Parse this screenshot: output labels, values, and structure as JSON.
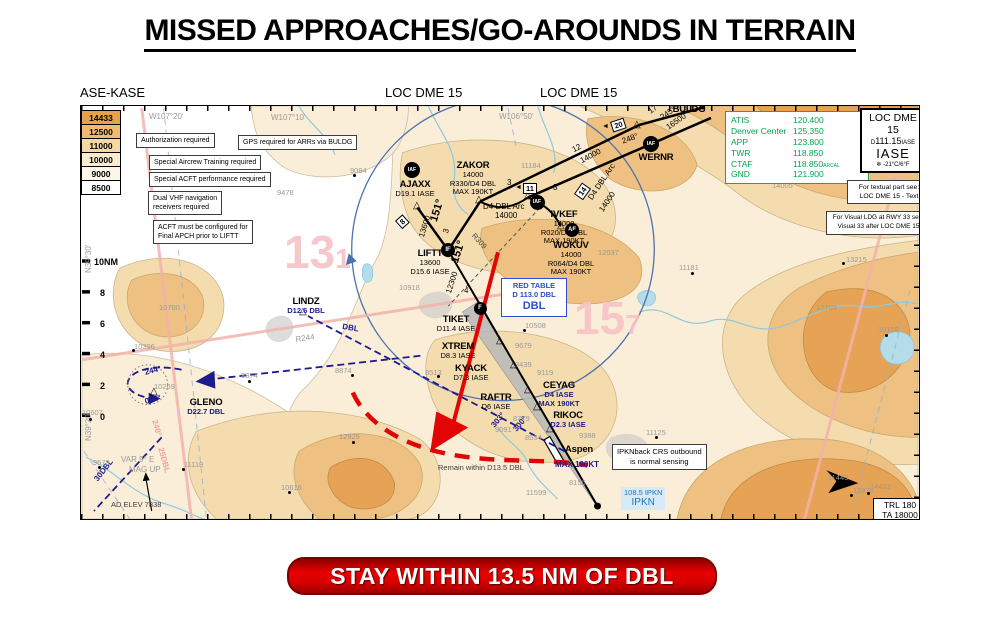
{
  "title": "MISSED APPROACHES/GO-AROUNDS IN TERRAIN",
  "header": {
    "chart_code": "ASE-KASE",
    "procedure_left": "LOC DME 15",
    "procedure_right": "LOC DME 15"
  },
  "banner": "STAY WITHIN 13.5 NM OF DBL",
  "elevation_legend": [
    {
      "value": "14433",
      "color": "#e7a14c"
    },
    {
      "value": "12500",
      "color": "#efba74"
    },
    {
      "value": "11000",
      "color": "#f6d8a5"
    },
    {
      "value": "10000",
      "color": "#fbeccf"
    },
    {
      "value": "9000",
      "color": "#fdf6e9"
    },
    {
      "value": "8500",
      "color": "#ffffff"
    }
  ],
  "notes": {
    "auth": "Authorization required",
    "gps": "GPS required for ARRs via BULDG",
    "training": "Special Aircrew Training required",
    "performance": "Special ACFT performance required",
    "dual_vhf": "Dual VHF navigation\nreceivers required",
    "config": "ACFT must be configured for\nFinal APCH prior to LIFTT",
    "ipkn": "IPKNback CRS outbound\nis normal sensing"
  },
  "comms": {
    "rows": [
      {
        "label": "ATIS",
        "value": "120.400"
      },
      {
        "label": "Denver Center",
        "value": "125.350"
      },
      {
        "label": "APP",
        "value": "123.800"
      },
      {
        "label": "TWR",
        "value": "118.850"
      },
      {
        "label": "CTAF",
        "value": "118.850",
        "suffix": "ARCAL"
      },
      {
        "label": "GND",
        "value": "121.900"
      }
    ]
  },
  "procedure_box": {
    "l1": "LOC DME",
    "l2": "15",
    "freq_prefix": "D",
    "freq": "111.15",
    "ident_small": "IASE",
    "ident": "IASE",
    "snow": "❄",
    "temp": "-21°C/6°F"
  },
  "ref_boxes": {
    "textual": "For textual part see:\nLOC DME 15 - Text",
    "visual": "For Visual LDG at RWY 33 see:\nVisual 33 after LOC DME 15"
  },
  "trl_box": {
    "l1": "TRL 180",
    "l2": "TA 18000"
  },
  "red_table": {
    "l1": "RED TABLE",
    "l2": "D 113.0 DBL",
    "l3": "DBL"
  },
  "ipkn_freq": {
    "l1": "108.5 IPKN",
    "l2": "IPKN"
  },
  "map": {
    "mora": [
      {
        "big": "13",
        "small": "1",
        "x": 283,
        "y": 228
      },
      {
        "big": "15",
        "small": "7",
        "x": 573,
        "y": 294
      }
    ],
    "waypoints": [
      {
        "n": "BULDG",
        "x": 688,
        "y": 104,
        "lines": []
      },
      {
        "n": "WERNR",
        "x": 655,
        "y": 152,
        "lines": []
      },
      {
        "n": "ZAKOR",
        "x": 472,
        "y": 160,
        "lines": [
          "14000",
          "R330/D4 DBL",
          "MAX 190KT"
        ]
      },
      {
        "n": "AJAXX",
        "x": 414,
        "y": 179,
        "lines": [
          "D19.1 IASE"
        ]
      },
      {
        "n": "IVKEF",
        "x": 563,
        "y": 209,
        "lines": [
          "14000",
          "R020/D4 DBL",
          "MAX 190KT"
        ]
      },
      {
        "n": "WOKUV",
        "x": 570,
        "y": 240,
        "lines": [
          "14000",
          "R064/D4 DBL",
          "MAX 190KT"
        ]
      },
      {
        "n": "LIFTT",
        "x": 429,
        "y": 248,
        "lines": [
          "13600",
          "D15.6 IASE"
        ]
      },
      {
        "n": "TIKET",
        "x": 455,
        "y": 314,
        "lines": [
          "D11.4 IASE"
        ]
      },
      {
        "n": "XTREM",
        "x": 457,
        "y": 341,
        "lines": [
          "D8.3 IASE"
        ]
      },
      {
        "n": "KYACK",
        "x": 470,
        "y": 363,
        "lines": [
          "D7.3 IASE"
        ]
      },
      {
        "n": "RAFTR",
        "x": 495,
        "y": 392,
        "lines": [
          "D6 IASE"
        ]
      },
      {
        "n": "CEYAG",
        "x": 558,
        "y": 380,
        "lines": [
          "D4 IASE",
          "MAX 190KT"
        ],
        "lc": "navy"
      },
      {
        "n": "RIKOC",
        "x": 567,
        "y": 410,
        "lines": [
          "D2.3 IASE"
        ],
        "lc": "navy"
      },
      {
        "n": "LINDZ",
        "x": 305,
        "y": 296,
        "lines": [
          "D12.6 DBL"
        ],
        "lc": "navy"
      },
      {
        "n": "GLENO",
        "x": 205,
        "y": 397,
        "lines": [
          "D22.7 DBL"
        ],
        "lc": "navy"
      },
      {
        "n": "Aspen",
        "x": 578,
        "y": 444,
        "lines": []
      }
    ],
    "badges": [
      {
        "t": "IAF",
        "x": 650,
        "y": 143,
        "s": 16
      },
      {
        "t": "IAF",
        "x": 411,
        "y": 169,
        "s": 16
      },
      {
        "t": "IAF",
        "x": 536,
        "y": 201,
        "s": 15
      },
      {
        "t": "AF",
        "x": 571,
        "y": 229,
        "s": 14
      },
      {
        "t": "IF",
        "x": 447,
        "y": 249,
        "s": 14
      },
      {
        "t": "F",
        "x": 479,
        "y": 307,
        "s": 13
      }
    ],
    "triangles": [
      [
        637,
        125
      ],
      [
        479,
        200
      ],
      [
        417,
        206
      ],
      [
        528,
        196
      ],
      [
        561,
        226
      ],
      [
        303,
        312
      ],
      [
        154,
        392
      ],
      [
        500,
        341
      ],
      [
        514,
        365
      ],
      [
        528,
        390
      ],
      [
        537,
        407
      ],
      [
        550,
        429
      ]
    ],
    "dme": [
      {
        "t": "20",
        "x": 609,
        "y": 121,
        "r": -18,
        "a": true
      },
      {
        "t": "11",
        "x": 522,
        "y": 182,
        "r": 0,
        "a": true
      },
      {
        "t": "14",
        "x": 573,
        "y": 193,
        "r": -55,
        "a": false
      },
      {
        "t": "8",
        "x": 394,
        "y": 220,
        "r": -42,
        "a": false
      }
    ],
    "labels": [
      {
        "t": "17",
        "x": 646,
        "y": 108,
        "r": -35
      },
      {
        "t": "245°",
        "x": 658,
        "y": 114,
        "r": -35
      },
      {
        "t": "16500",
        "x": 664,
        "y": 124,
        "r": -35
      },
      {
        "t": "248°",
        "x": 620,
        "y": 137,
        "r": -20
      },
      {
        "t": "12",
        "x": 570,
        "y": 146,
        "r": -28
      },
      {
        "t": "14000",
        "x": 578,
        "y": 157,
        "r": -28
      },
      {
        "t": "3",
        "x": 506,
        "y": 178
      },
      {
        "t": "3",
        "x": 552,
        "y": 183
      },
      {
        "t": "D4 DBL Arc",
        "x": 482,
        "y": 202
      },
      {
        "t": "14000",
        "x": 494,
        "y": 211
      },
      {
        "t": "D4 DBL Arc",
        "x": 586,
        "y": 196,
        "r": -56
      },
      {
        "t": "14000",
        "x": 597,
        "y": 208,
        "r": -56
      },
      {
        "t": "151°",
        "x": 428,
        "y": 219,
        "r": -73,
        "c": "big"
      },
      {
        "t": "3",
        "x": 441,
        "y": 231,
        "r": -73
      },
      {
        "t": "13600",
        "x": 417,
        "y": 235,
        "r": -73
      },
      {
        "t": "151°",
        "x": 449,
        "y": 260,
        "r": -72,
        "c": "big"
      },
      {
        "t": "4",
        "x": 463,
        "y": 286
      },
      {
        "t": "12300",
        "x": 444,
        "y": 291,
        "r": -72
      },
      {
        "t": "R309",
        "x": 475,
        "y": 231,
        "r": 48,
        "c": "d"
      },
      {
        "t": "R244",
        "x": 294,
        "y": 335,
        "r": -8,
        "c": "g"
      },
      {
        "t": "DBL",
        "x": 342,
        "y": 322,
        "r": 9,
        "c": "n"
      },
      {
        "t": "303°",
        "x": 489,
        "y": 423,
        "r": -50,
        "c": "n"
      },
      {
        "t": "300°",
        "x": 511,
        "y": 427,
        "r": -50,
        "c": "n"
      },
      {
        "t": "30DBL",
        "x": 92,
        "y": 477,
        "r": -52,
        "c": "n"
      },
      {
        "t": "244°",
        "x": 143,
        "y": 368,
        "r": -14,
        "c": "n"
      },
      {
        "t": "064°",
        "x": 143,
        "y": 397,
        "r": -14,
        "c": "n"
      },
      {
        "t": "240°",
        "x": 157,
        "y": 418,
        "r": 74,
        "c": "p"
      },
      {
        "t": "25DBL",
        "x": 163,
        "y": 446,
        "r": 74,
        "c": "p"
      },
      {
        "t": "MAX 190KT",
        "x": 554,
        "y": 460,
        "c": "n"
      },
      {
        "t": "Remain within D13.5 DBL",
        "x": 437,
        "y": 463,
        "c": "d"
      },
      {
        "t": "VAR 9° E",
        "x": 120,
        "y": 455,
        "c": "g"
      },
      {
        "t": "MAG UP",
        "x": 128,
        "y": 465,
        "c": "g"
      },
      {
        "t": "AD ELEV 7838",
        "x": 110,
        "y": 500,
        "c": "d"
      },
      {
        "t": "W107°20'",
        "x": 148,
        "y": 112,
        "c": "g"
      },
      {
        "t": "W107°10'",
        "x": 270,
        "y": 113,
        "c": "g"
      },
      {
        "t": "W106°50'",
        "x": 498,
        "y": 112,
        "c": "g"
      },
      {
        "t": "N39°30'",
        "x": 84,
        "y": 272,
        "r": -90,
        "c": "g"
      },
      {
        "t": "N39°20'",
        "x": 84,
        "y": 440,
        "r": -90,
        "c": "g"
      },
      {
        "t": "10NM",
        "x": 93,
        "y": 257,
        "c": "s"
      },
      {
        "t": "8",
        "x": 99,
        "y": 288,
        "c": "s"
      },
      {
        "t": "6",
        "x": 99,
        "y": 319,
        "c": "s"
      },
      {
        "t": "4",
        "x": 99,
        "y": 350,
        "c": "s"
      },
      {
        "t": "2",
        "x": 99,
        "y": 381,
        "c": "s"
      },
      {
        "t": "0",
        "x": 99,
        "y": 412,
        "c": "s"
      }
    ],
    "spots": [
      {
        "t": "9084",
        "x": 349,
        "y": 166
      },
      {
        "t": "9478",
        "x": 276,
        "y": 188
      },
      {
        "t": "11184",
        "x": 520,
        "y": 161
      },
      {
        "t": "14005",
        "x": 771,
        "y": 181
      },
      {
        "t": "10918",
        "x": 398,
        "y": 283
      },
      {
        "t": "10700",
        "x": 158,
        "y": 303
      },
      {
        "t": "10396",
        "x": 133,
        "y": 342
      },
      {
        "t": "8874",
        "x": 240,
        "y": 371
      },
      {
        "t": "8874",
        "x": 334,
        "y": 366
      },
      {
        "t": "10607",
        "x": 81,
        "y": 408
      },
      {
        "t": "10269",
        "x": 153,
        "y": 382
      },
      {
        "t": "9573",
        "x": 92,
        "y": 458
      },
      {
        "t": "11118",
        "x": 183,
        "y": 460
      },
      {
        "t": "10616",
        "x": 280,
        "y": 483
      },
      {
        "t": "12926",
        "x": 338,
        "y": 432
      },
      {
        "t": "11599",
        "x": 525,
        "y": 488
      },
      {
        "t": "8156",
        "x": 568,
        "y": 478
      },
      {
        "t": "8779",
        "x": 512,
        "y": 414
      },
      {
        "t": "9091",
        "x": 494,
        "y": 425
      },
      {
        "t": "8534",
        "x": 524,
        "y": 433
      },
      {
        "t": "9388",
        "x": 578,
        "y": 431
      },
      {
        "t": "9119",
        "x": 536,
        "y": 368
      },
      {
        "t": "9439",
        "x": 514,
        "y": 360
      },
      {
        "t": "9679",
        "x": 514,
        "y": 341
      },
      {
        "t": "8513",
        "x": 424,
        "y": 368
      },
      {
        "t": "10508",
        "x": 524,
        "y": 321
      },
      {
        "t": "12037",
        "x": 597,
        "y": 248
      },
      {
        "t": "11181",
        "x": 678,
        "y": 263
      },
      {
        "t": "13215",
        "x": 845,
        "y": 255
      },
      {
        "t": "12703",
        "x": 815,
        "y": 303
      },
      {
        "t": "10108",
        "x": 877,
        "y": 325
      },
      {
        "t": "12870",
        "x": 852,
        "y": 486
      },
      {
        "t": "11443",
        "x": 827,
        "y": 473
      },
      {
        "t": "11125",
        "x": 645,
        "y": 428
      },
      {
        "t": "14433",
        "x": 869,
        "y": 482
      }
    ],
    "dots": [
      [
        352,
        173
      ],
      [
        786,
        178
      ],
      [
        131,
        348
      ],
      [
        247,
        379
      ],
      [
        350,
        373
      ],
      [
        88,
        417
      ],
      [
        97,
        465
      ],
      [
        181,
        467
      ],
      [
        287,
        490
      ],
      [
        351,
        440
      ],
      [
        436,
        374
      ],
      [
        522,
        328
      ],
      [
        690,
        271
      ],
      [
        841,
        261
      ],
      [
        884,
        333
      ],
      [
        849,
        493
      ],
      [
        838,
        481
      ],
      [
        654,
        435
      ],
      [
        866,
        491
      ]
    ]
  }
}
